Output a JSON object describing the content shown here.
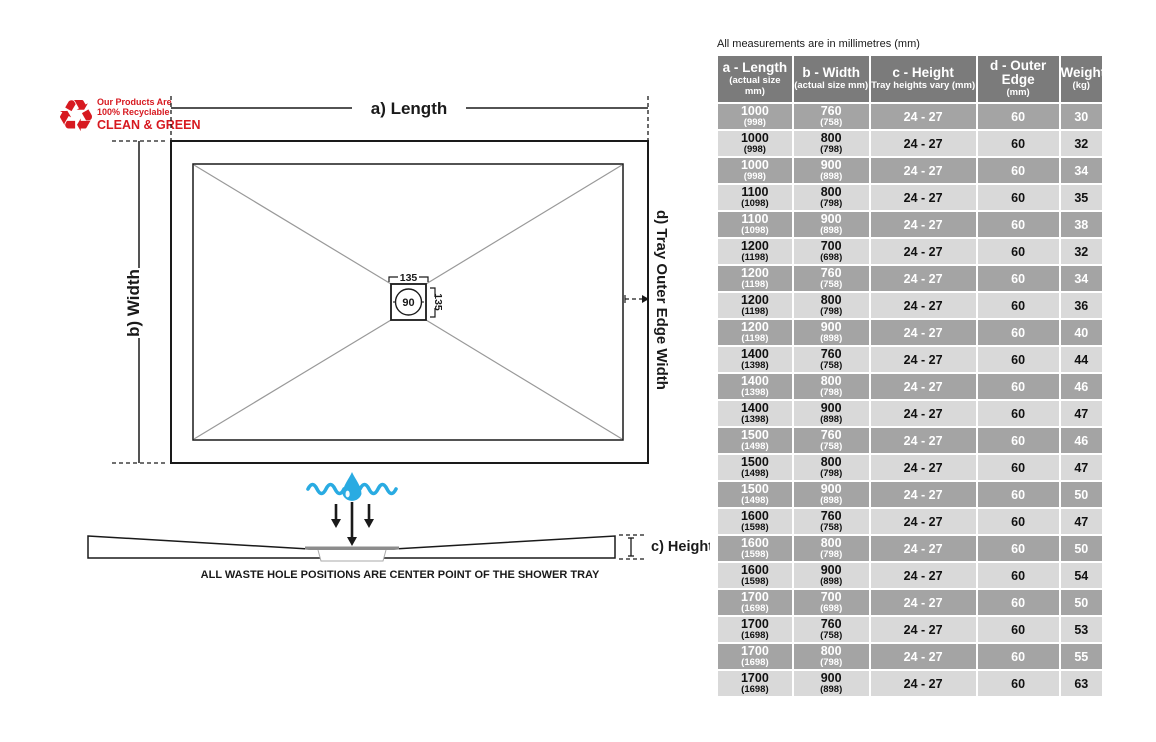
{
  "diagram": {
    "recycle_badge": {
      "line1": "Our Products Are",
      "line2": "100% Recyclable",
      "line3": "CLEAN & GREEN"
    },
    "labels": {
      "length": "a) Length",
      "width": "b) Width",
      "outer_edge": "d) Tray Outer Edge Width",
      "height": "c) Height"
    },
    "waste_hole": {
      "width": "135",
      "height": "135",
      "diameter": "90"
    },
    "caption": "ALL WASTE HOLE POSITIONS ARE CENTER POINT OF THE SHOWER TRAY",
    "colors": {
      "red": "#d71920",
      "blue": "#29abe2",
      "line_gray": "#999999"
    }
  },
  "table": {
    "note": "All measurements are in millimetres (mm)",
    "headers": [
      {
        "title": "a - Length",
        "sub": "(actual size mm)"
      },
      {
        "title": "b - Width",
        "sub": "(actual size mm)"
      },
      {
        "title": "c - Height",
        "sub": "Tray heights vary (mm)"
      },
      {
        "title": "d - Outer Edge",
        "sub": "(mm)"
      },
      {
        "title": "Weight",
        "sub": "(kg)"
      }
    ],
    "rows": [
      {
        "length": "1000",
        "length_actual": "(998)",
        "width": "760",
        "width_actual": "(758)",
        "height": "24 - 27",
        "outer": "60",
        "weight": "30"
      },
      {
        "length": "1000",
        "length_actual": "(998)",
        "width": "800",
        "width_actual": "(798)",
        "height": "24 - 27",
        "outer": "60",
        "weight": "32"
      },
      {
        "length": "1000",
        "length_actual": "(998)",
        "width": "900",
        "width_actual": "(898)",
        "height": "24 - 27",
        "outer": "60",
        "weight": "34"
      },
      {
        "length": "1100",
        "length_actual": "(1098)",
        "width": "800",
        "width_actual": "(798)",
        "height": "24 - 27",
        "outer": "60",
        "weight": "35"
      },
      {
        "length": "1100",
        "length_actual": "(1098)",
        "width": "900",
        "width_actual": "(898)",
        "height": "24 - 27",
        "outer": "60",
        "weight": "38"
      },
      {
        "length": "1200",
        "length_actual": "(1198)",
        "width": "700",
        "width_actual": "(698)",
        "height": "24 - 27",
        "outer": "60",
        "weight": "32"
      },
      {
        "length": "1200",
        "length_actual": "(1198)",
        "width": "760",
        "width_actual": "(758)",
        "height": "24 - 27",
        "outer": "60",
        "weight": "34"
      },
      {
        "length": "1200",
        "length_actual": "(1198)",
        "width": "800",
        "width_actual": "(798)",
        "height": "24 - 27",
        "outer": "60",
        "weight": "36"
      },
      {
        "length": "1200",
        "length_actual": "(1198)",
        "width": "900",
        "width_actual": "(898)",
        "height": "24 - 27",
        "outer": "60",
        "weight": "40"
      },
      {
        "length": "1400",
        "length_actual": "(1398)",
        "width": "760",
        "width_actual": "(758)",
        "height": "24 - 27",
        "outer": "60",
        "weight": "44"
      },
      {
        "length": "1400",
        "length_actual": "(1398)",
        "width": "800",
        "width_actual": "(798)",
        "height": "24 - 27",
        "outer": "60",
        "weight": "46"
      },
      {
        "length": "1400",
        "length_actual": "(1398)",
        "width": "900",
        "width_actual": "(898)",
        "height": "24 - 27",
        "outer": "60",
        "weight": "47"
      },
      {
        "length": "1500",
        "length_actual": "(1498)",
        "width": "760",
        "width_actual": "(758)",
        "height": "24 - 27",
        "outer": "60",
        "weight": "46"
      },
      {
        "length": "1500",
        "length_actual": "(1498)",
        "width": "800",
        "width_actual": "(798)",
        "height": "24 - 27",
        "outer": "60",
        "weight": "47"
      },
      {
        "length": "1500",
        "length_actual": "(1498)",
        "width": "900",
        "width_actual": "(898)",
        "height": "24 - 27",
        "outer": "60",
        "weight": "50"
      },
      {
        "length": "1600",
        "length_actual": "(1598)",
        "width": "760",
        "width_actual": "(758)",
        "height": "24 - 27",
        "outer": "60",
        "weight": "47"
      },
      {
        "length": "1600",
        "length_actual": "(1598)",
        "width": "800",
        "width_actual": "(798)",
        "height": "24 - 27",
        "outer": "60",
        "weight": "50"
      },
      {
        "length": "1600",
        "length_actual": "(1598)",
        "width": "900",
        "width_actual": "(898)",
        "height": "24 - 27",
        "outer": "60",
        "weight": "54"
      },
      {
        "length": "1700",
        "length_actual": "(1698)",
        "width": "700",
        "width_actual": "(698)",
        "height": "24 - 27",
        "outer": "60",
        "weight": "50"
      },
      {
        "length": "1700",
        "length_actual": "(1698)",
        "width": "760",
        "width_actual": "(758)",
        "height": "24 - 27",
        "outer": "60",
        "weight": "53"
      },
      {
        "length": "1700",
        "length_actual": "(1698)",
        "width": "800",
        "width_actual": "(798)",
        "height": "24 - 27",
        "outer": "60",
        "weight": "55"
      },
      {
        "length": "1700",
        "length_actual": "(1698)",
        "width": "900",
        "width_actual": "(898)",
        "height": "24 - 27",
        "outer": "60",
        "weight": "63"
      }
    ],
    "colors": {
      "header_bg": "#7b7b7b",
      "row_dark": "#a4a4a4",
      "row_light": "#d9d9d9"
    }
  }
}
